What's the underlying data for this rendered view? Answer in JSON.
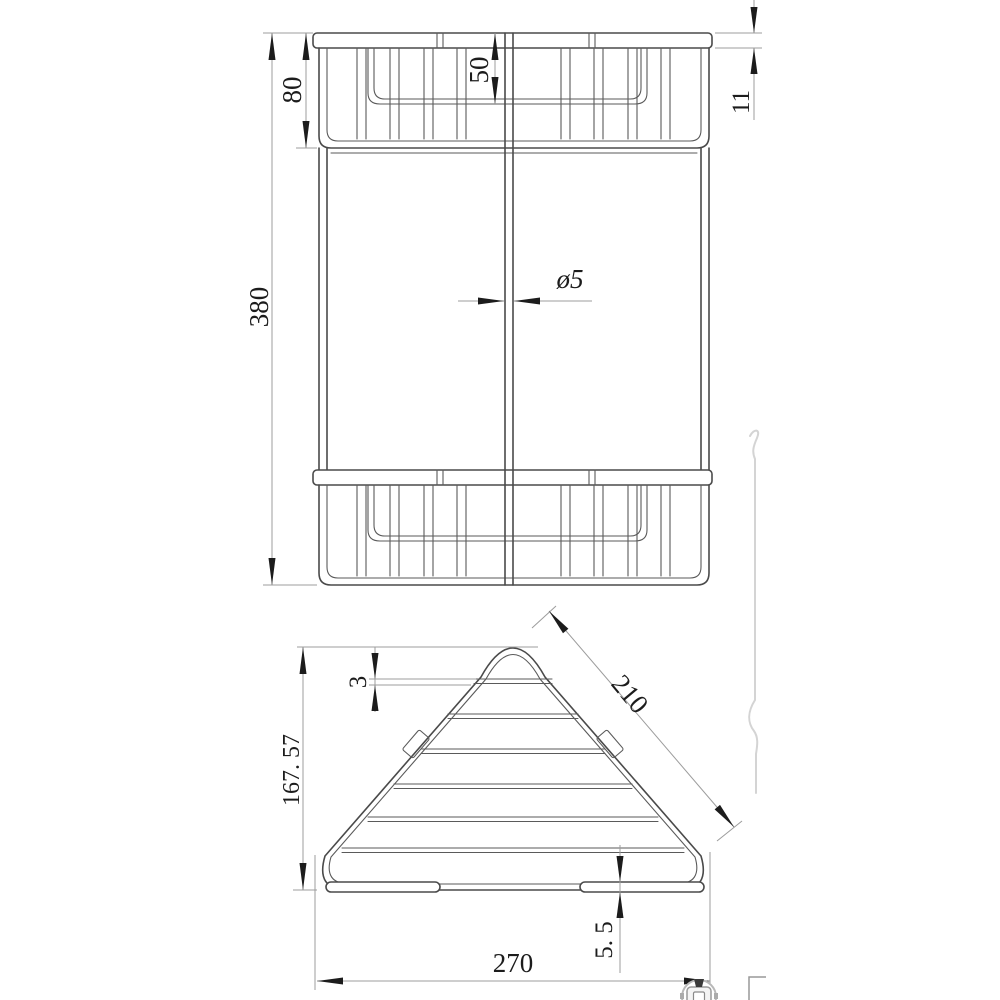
{
  "meta": {
    "drawing_type": "two-tier corner wire basket technical drawing",
    "background": "#ffffff",
    "object_line_color": "#4a4a4a",
    "dimension_line_color": "#9c9c9c",
    "text_color": "#1c1c1c"
  },
  "views": {
    "front": {
      "dims": {
        "overall_height": "380",
        "tier_height": "80",
        "basket_inner_depth": "50",
        "rim_band_height": "11",
        "wire_diameter": "ø5"
      }
    },
    "plan": {
      "dims": {
        "depth": "167. 57",
        "top_wire_diameter": "3",
        "side_length": "210",
        "front_width": "270",
        "foot_wire_diameter": "5. 5"
      }
    }
  }
}
